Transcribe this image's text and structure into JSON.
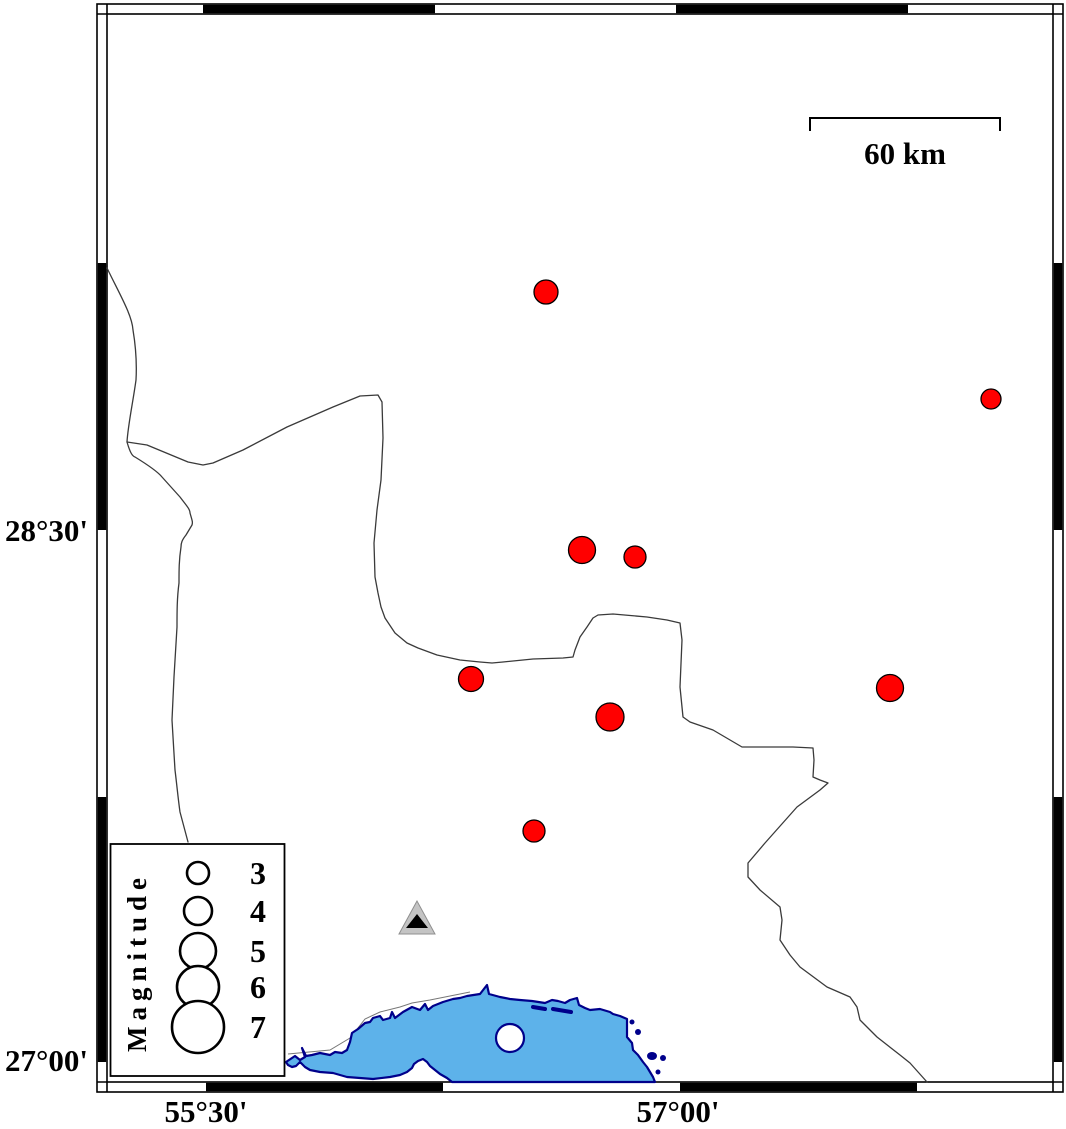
{
  "axis": {
    "lat_upper": "28°30'",
    "lat_lower": "27°00'",
    "lon_left": "55°30'",
    "lon_right": "57°00'"
  },
  "scale_bar": {
    "label": "60 km"
  },
  "legend": {
    "title": "Magnitude",
    "entries": [
      {
        "magnitude": "3",
        "radius": 11,
        "cy": 873
      },
      {
        "magnitude": "4",
        "radius": 14,
        "cy": 911
      },
      {
        "magnitude": "5",
        "radius": 18,
        "cy": 951
      },
      {
        "magnitude": "6",
        "radius": 21,
        "cy": 987
      },
      {
        "magnitude": "7",
        "radius": 26,
        "cy": 1027
      }
    ],
    "circle_cx": 198,
    "number_x": 258
  },
  "earthquakes": [
    {
      "x": 546,
      "y": 292,
      "r": 12
    },
    {
      "x": 991,
      "y": 399,
      "r": 10
    },
    {
      "x": 582,
      "y": 550,
      "r": 13.5
    },
    {
      "x": 635,
      "y": 557,
      "r": 11
    },
    {
      "x": 471,
      "y": 679,
      "r": 12.5
    },
    {
      "x": 610,
      "y": 717,
      "r": 14
    },
    {
      "x": 890,
      "y": 688,
      "r": 13.5
    },
    {
      "x": 534,
      "y": 831,
      "r": 11
    }
  ],
  "station": {
    "symbol": "triangle",
    "x": 417,
    "y": 922
  },
  "colors": {
    "earthquake": "#ff0000",
    "sea": "#5db2ea",
    "coastline": "#00008b",
    "land": "#ffffff",
    "station_outer": "#c4c4c4",
    "station_inner": "#000000",
    "frame": "#000000"
  }
}
